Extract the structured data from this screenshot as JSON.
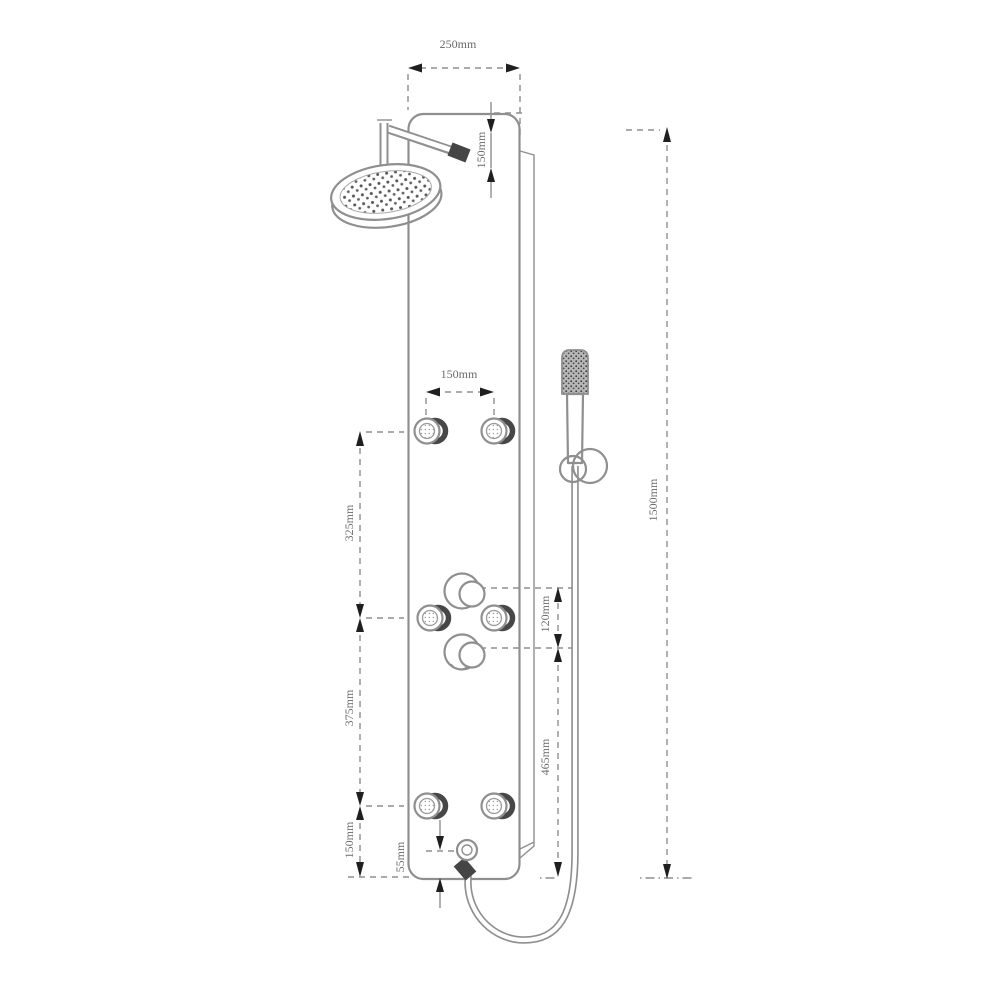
{
  "drawing": {
    "title": "Shower panel technical dimension drawing",
    "background": "#ffffff",
    "colors": {
      "line": "#8f8f8f",
      "dark_fitting": "#454545",
      "arrowhead": "#1f1f1f",
      "label_text": "#6a6a6a"
    },
    "dimensions": {
      "top_width": "250mm",
      "head_drop": "150mm",
      "total_height": "1500mm",
      "jet_spacing": "150mm",
      "jets_to_controls": "325mm",
      "controls_to_lower_jets": "375mm",
      "lower_jets_to_base": "150mm",
      "knob_spacing": "120mm",
      "controls_to_base": "465mm",
      "outlet_height": "55mm"
    },
    "components": [
      "shower-panel-body",
      "side-panel-edge",
      "rain-shower-head",
      "shower-arm",
      "body-jet-top-left",
      "body-jet-top-right",
      "body-jet-mid-left",
      "body-jet-mid-right",
      "body-jet-bottom-left",
      "body-jet-bottom-right",
      "control-knob-upper",
      "control-knob-lower",
      "hand-shower",
      "hand-shower-holder",
      "shower-hose",
      "hose-outlet-elbow"
    ]
  }
}
